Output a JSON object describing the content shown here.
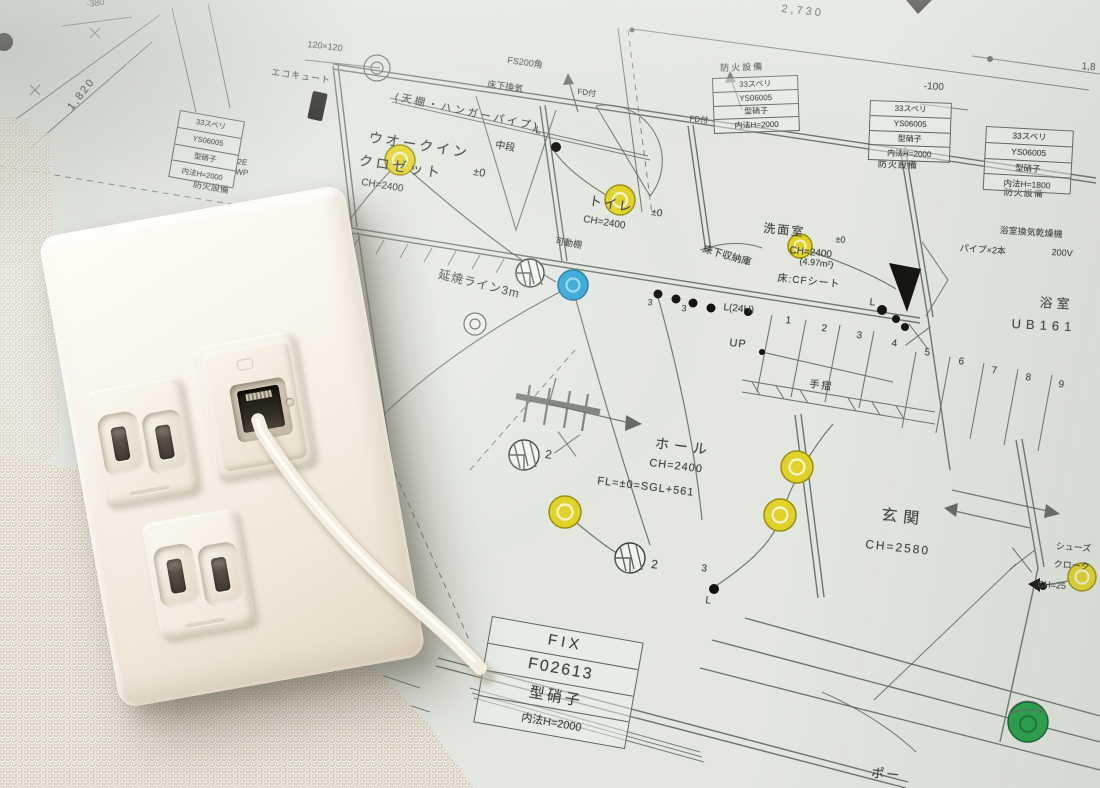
{
  "colors": {
    "paper": "#e3e7e0",
    "line": "#5c655f",
    "ink": "#3a403c",
    "light-yellow": "#e0d229",
    "light-yellow-ring": "#9a8e10",
    "fan-blue": "#2aa3d4",
    "marker-green": "#1f9e45",
    "plate-cream": "#f7f2e9",
    "cable-white": "#f3ede2"
  },
  "plan": {
    "dimensions": {
      "top_width": "2,730",
      "top_right_partial": "1,8",
      "left_height": "1,820",
      "left_offset": "-380",
      "column_size": "120×120",
      "level_offset": "-100"
    },
    "rooms": {
      "walk_in_closet": {
        "name_line1": "ウオークイン",
        "name_line2": "クロゼット",
        "level": "±0",
        "ceiling": "CH=2400"
      },
      "toilet": {
        "name": "トイレ",
        "level": "±0",
        "ceiling": "CH=2400"
      },
      "washroom": {
        "name": "洗面室",
        "level": "±0",
        "ceiling": "CH=2400",
        "area": "(4.97m²)",
        "floor": "床:CFシート"
      },
      "bathroom": {
        "name": "浴室",
        "unit": "UB161"
      },
      "hall": {
        "name": "ホール",
        "ceiling": "CH=2400",
        "floor_level": "FL=±0=SGL+561"
      },
      "entrance": {
        "name": "玄関",
        "ceiling": "CH=2580"
      },
      "shoe_closet": {
        "name_line1": "シューズ",
        "name_line2": "クローク",
        "ceiling": "CH=25"
      },
      "porch": {
        "name": "ポー"
      }
    },
    "annotations": {
      "fire_line": "延焼ライン3m",
      "eco_cute": "エコキュート",
      "ps_duct": "FS200角",
      "underfloor_vent": "床下換気",
      "fd_1": "FD付",
      "fd_2": "FD付",
      "hanger_pipe": "(天棚・ハンガーパイプ)",
      "middle_shelf": "中段",
      "movable_shelf": "可動棚",
      "underfloor_storage": "床下収納庫",
      "light_24h": "L(24H)",
      "up": "UP",
      "handrail": "手摺",
      "bath_vent": "浴室換気乾燥機",
      "bath_vent_voltage": "200V",
      "bath_pipes": "パイプ×2本",
      "fire_equipment": "防火設備",
      "floor_mark_2e": "2E",
      "floor_mark_wp": "WP",
      "level_zero": "±0",
      "l_mark": "L",
      "circuit_3": "3",
      "switch_2": "2"
    },
    "windows": [
      {
        "rows": [
          "33スベリ",
          "YS06005",
          "型硝子",
          "内法H=2000"
        ],
        "fire": "防火設備"
      },
      {
        "rows": [
          "33スベリ",
          "YS06005",
          "型硝子",
          "内法H=2000"
        ],
        "fire": "防火設備"
      },
      {
        "rows": [
          "33スベリ",
          "YS06005",
          "型硝子",
          "内法H=2000"
        ],
        "fire": "防火設備"
      },
      {
        "rows": [
          "33スベリ",
          "YS06005",
          "型硝子",
          "内法H=1800"
        ],
        "fire": "防火設備"
      }
    ],
    "fix_window": {
      "rows": [
        "FIX",
        "F02613",
        "型硝子",
        "内法H=2000"
      ]
    },
    "stair_numbers": [
      "1",
      "2",
      "3",
      "4",
      "5",
      "6",
      "7",
      "8",
      "9"
    ]
  }
}
